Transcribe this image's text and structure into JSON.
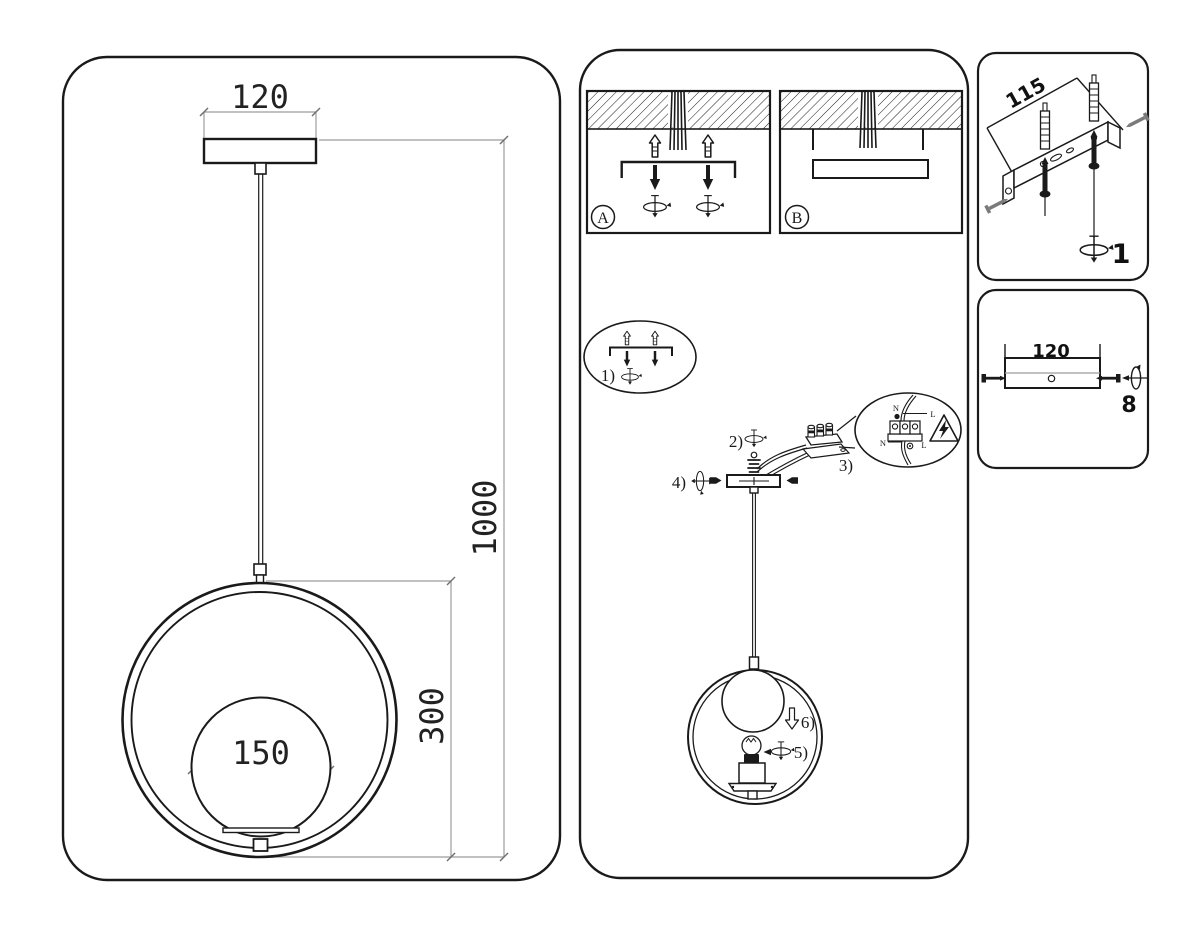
{
  "document": {
    "kind": "pendant-lamp installation instruction sheet"
  },
  "dimensions_panel": {
    "canopy_width": "120",
    "drop_height": "1000",
    "ring_height": "300",
    "sphere_diameter": "150"
  },
  "installation_panel": {
    "option_a_label": "A",
    "option_b_label": "B",
    "step_labels": {
      "s1": "1)",
      "s2": "2)",
      "s3": "3)",
      "s4": "4)",
      "s5": "5)",
      "s6": "6)"
    },
    "wiring_detail": {
      "top_neutral": "N",
      "top_line": "L",
      "bottom_neutral": "N",
      "bottom_line": "L"
    }
  },
  "bracket_panel": {
    "hole_spacing": "115",
    "step_label": "1"
  },
  "canopy_panel": {
    "width": "120",
    "step_label": "8"
  },
  "colors": {
    "line": "#1a1a1a",
    "dim_line": "#9c9c9c",
    "gray_part": "#7a7a7a",
    "background": "#ffffff"
  }
}
